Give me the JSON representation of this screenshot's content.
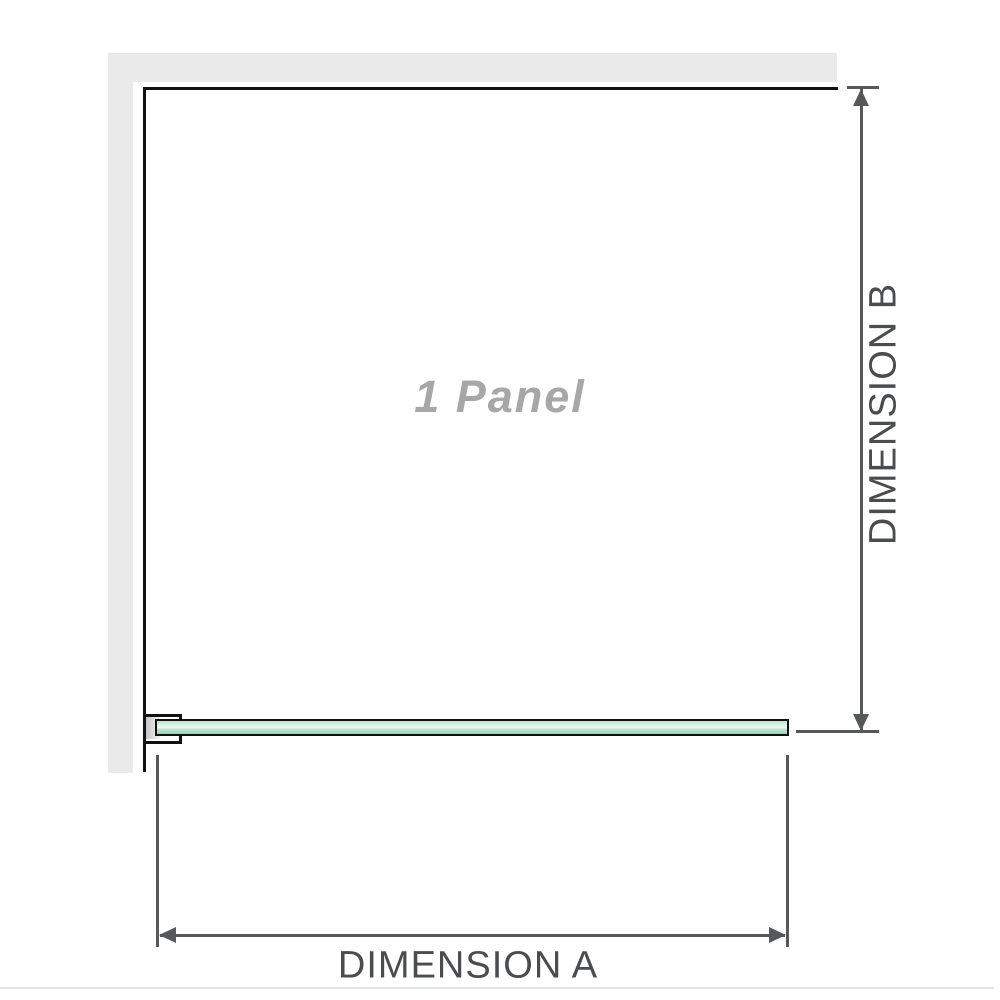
{
  "diagram": {
    "panel_label": "1 Panel",
    "dimensions": {
      "a": {
        "label": "DIMENSION A"
      },
      "b": {
        "label": "DIMENSION B"
      }
    }
  },
  "colors": {
    "wall_fill": "#eaeaea",
    "outline_black": "#111111",
    "dim_color": "#57585a",
    "dim_text": "#4b4c4e",
    "panel_text": "#a7a7a7",
    "glass_light": "#dff2e8",
    "glass_highlight": "#eff9f3",
    "glass_mid": "#b9e4ce",
    "glass_dark": "#98d5b8",
    "bottom_border": "#e1e5e1"
  }
}
